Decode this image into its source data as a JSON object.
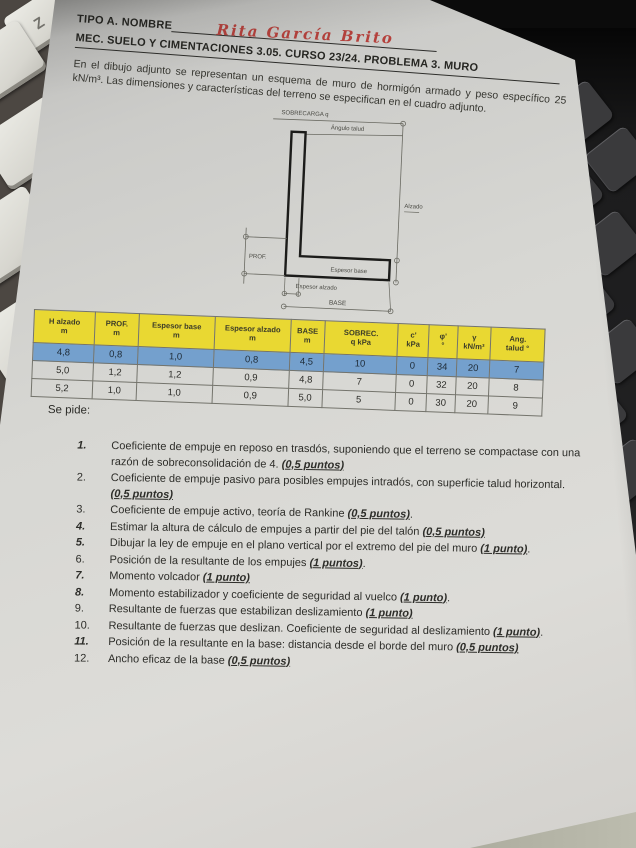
{
  "environment": {
    "key_label": "Z"
  },
  "header": {
    "line1_label": "TIPO A. NOMBRE",
    "handwritten_name": "Rita García Brito",
    "line2": "MEC. SUELO Y CIMENTACIONES 3.05. CURSO 23/24. PROBLEMA 3. MURO",
    "intro": "En el dibujo adjunto se representan un esquema de muro de hormigón armado y peso específico 25 kN/m³. Las dimensiones y características del terreno se especifican en el cuadro adjunto."
  },
  "figure": {
    "labels": {
      "surcharge": "SOBRECARGA q",
      "slope_angle": "Ángulo talud",
      "height": "Alzado",
      "depth": "PROF.",
      "base_thickness": "Espesor base",
      "stem_thickness": "Espesor alzado",
      "base": "BASE"
    }
  },
  "table": {
    "headers": [
      [
        "H alzado",
        "m"
      ],
      [
        "PROF.",
        "m"
      ],
      [
        "Espesor base",
        "m"
      ],
      [
        "Espesor alzado",
        "m"
      ],
      [
        "BASE",
        "m"
      ],
      [
        "SOBREC.",
        "q kPa"
      ],
      [
        "c'",
        "kPa"
      ],
      [
        "φ'",
        "°"
      ],
      [
        "γ",
        "kN/m³"
      ],
      [
        "Ang.",
        "talud °"
      ]
    ],
    "rows": [
      {
        "cells": [
          "4,8",
          "0,8",
          "1,0",
          "0,8",
          "4,5",
          "10",
          "0",
          "34",
          "20",
          "7"
        ],
        "highlight": true
      },
      {
        "cells": [
          "5,0",
          "1,2",
          "1,2",
          "0,9",
          "4,8",
          "7",
          "0",
          "32",
          "20",
          "8"
        ],
        "highlight": false
      },
      {
        "cells": [
          "5,2",
          "1,0",
          "1,0",
          "0,9",
          "5,0",
          "5",
          "0",
          "30",
          "20",
          "9"
        ],
        "highlight": false
      }
    ],
    "colors": {
      "header_bg": "#e9d832",
      "highlight_bg": "#74a0cd"
    }
  },
  "tasks": {
    "heading": "Se pide:",
    "items": [
      {
        "n": "1.",
        "text": "Coeficiente de empuje en reposo en trasdós, suponiendo que el terreno se compactase con una razón de sobreconsolidación de 4. ",
        "points": "(0,5 puntos)",
        "bold_num": true
      },
      {
        "n": "2.",
        "text": "Coeficiente de empuje pasivo para posibles empujes intradós, con superficie talud horizontal. ",
        "points": "(0,5 puntos)",
        "bold_num": false
      },
      {
        "n": "3.",
        "text": "Coeficiente de empuje activo, teoría de Rankine ",
        "points": "(0,5 puntos)",
        "after": ".",
        "bold_num": false
      },
      {
        "n": "4.",
        "text": "Estimar la altura de cálculo de empujes a partir del pie del talón ",
        "points": "(0,5 puntos)",
        "bold_num": true
      },
      {
        "n": "5.",
        "text": "Dibujar la ley de empuje en el plano vertical por el extremo del pie del muro ",
        "points": "(1 punto)",
        "after": ".",
        "bold_num": true
      },
      {
        "n": "6.",
        "text": "Posición de la resultante de los empujes ",
        "points": "(1 puntos)",
        "after": ".",
        "bold_num": false
      },
      {
        "n": "7.",
        "text": "Momento volcador ",
        "points": "(1 punto)",
        "bold_num": true
      },
      {
        "n": "8.",
        "text": "Momento estabilizador y coeficiente de seguridad al vuelco ",
        "points": "(1 punto)",
        "after": ".",
        "bold_num": true
      },
      {
        "n": "9.",
        "text": "Resultante de fuerzas que estabilizan deslizamiento ",
        "points": "(1 punto)",
        "bold_num": false
      },
      {
        "n": "10.",
        "text": "Resultante de fuerzas que deslizan. Coeficiente de seguridad al deslizamiento ",
        "points": "(1 punto)",
        "after": ".",
        "bold_num": false
      },
      {
        "n": "11.",
        "text": "Posición de la resultante en la base: distancia desde el borde del muro ",
        "points": "(0,5 puntos)",
        "bold_num": true
      },
      {
        "n": "12.",
        "text": "Ancho eficaz de la base ",
        "points": "(0,5 puntos)",
        "bold_num": false
      }
    ]
  }
}
